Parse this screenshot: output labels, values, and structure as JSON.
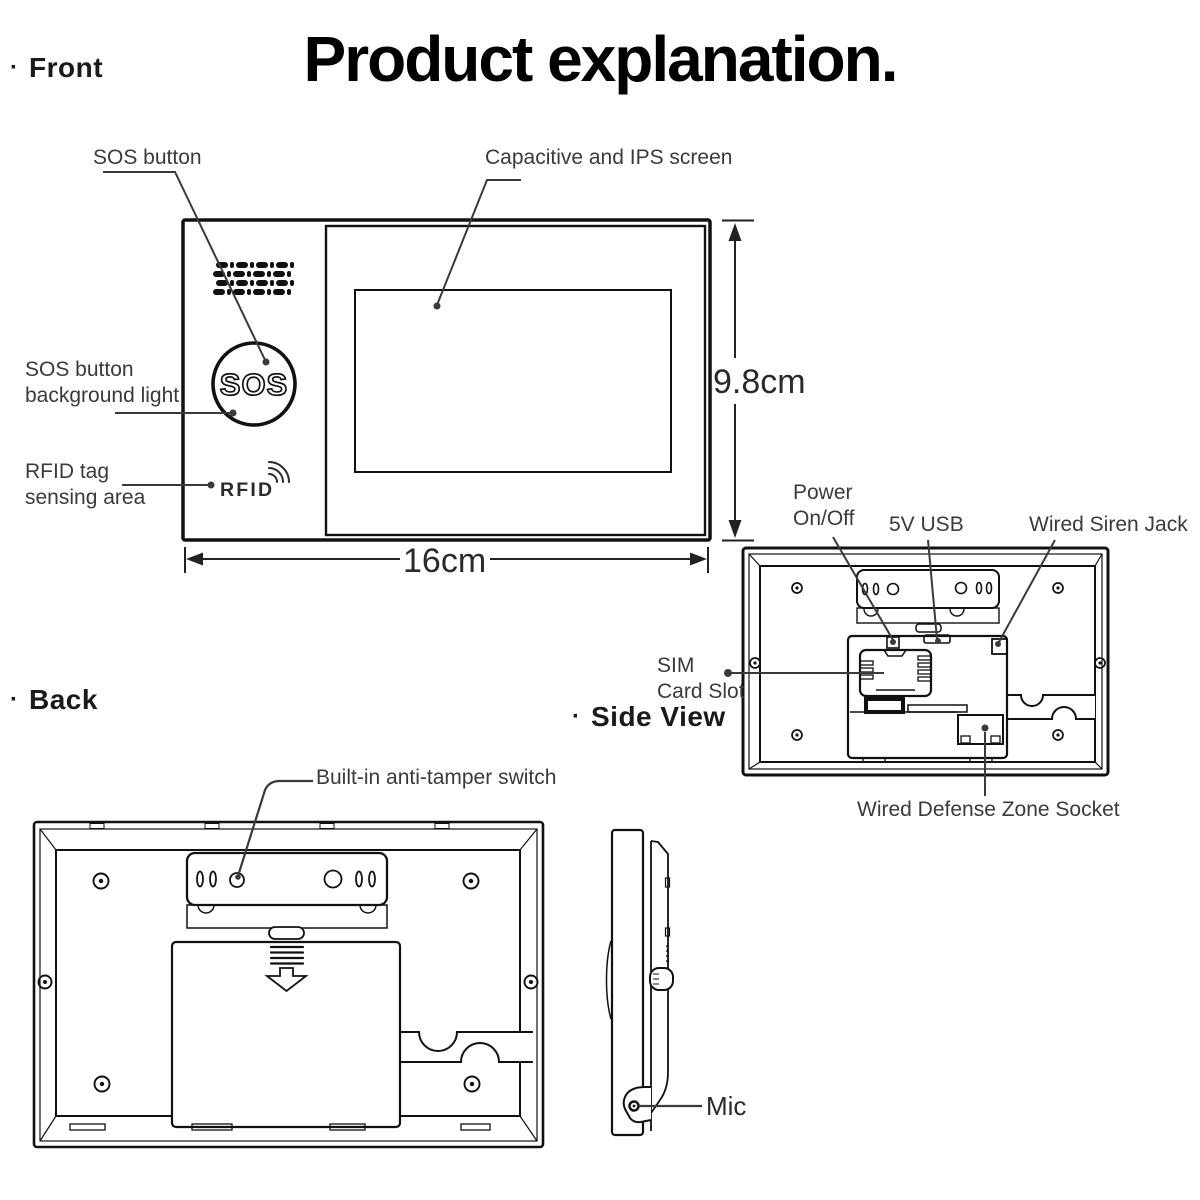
{
  "title": "Product explanation.",
  "sections": {
    "front": {
      "bullet": "·",
      "label": "Front"
    },
    "back": {
      "bullet": "·",
      "label": "Back"
    },
    "side": {
      "bullet": "·",
      "label": "Side View"
    }
  },
  "front_view": {
    "sos_button_label": "SOS button",
    "screen_label": "Capacitive and IPS screen",
    "sos_light_label": "SOS button\nbackground light",
    "rfid_label": "RFID tag\nsensing area",
    "sos_text": "SOS",
    "rfid_text": "RFID",
    "width_dim": "16cm",
    "height_dim": "9.8cm"
  },
  "back_detail": {
    "power_label": "Power\nOn/Off",
    "usb_label": "5V USB",
    "siren_label": "Wired Siren Jack",
    "sim_label": "SIM\nCard Slot",
    "defense_label": "Wired Defense Zone Socket"
  },
  "back_view": {
    "tamper_label": "Built-in anti-tamper switch"
  },
  "side_view": {
    "mic_label": "Mic"
  },
  "colors": {
    "line": "#1a1a1a",
    "text": "#3a3a3a",
    "title": "#000000"
  }
}
